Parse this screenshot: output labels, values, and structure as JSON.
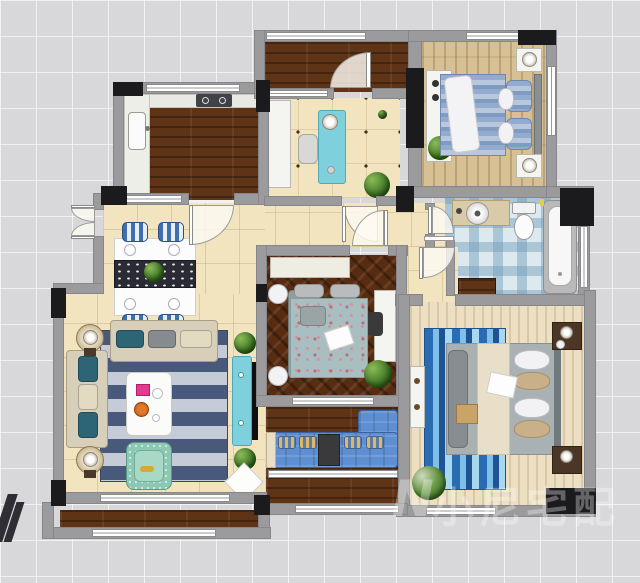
{
  "plan_title": "apartment-floor-plan-top-view",
  "watermark": {
    "logo": "N",
    "text": "小尼宅配",
    "color": "#ffffff",
    "opacity": 0.32
  },
  "rooms": [
    {
      "id": "kitchen",
      "name": "Kitchen",
      "furniture": [
        "l-counter",
        "sink",
        "cooktop",
        "dark-wood-floor"
      ]
    },
    {
      "id": "north-balcony",
      "name": "North Balcony",
      "furniture": [
        "wood-floor",
        "door"
      ]
    },
    {
      "id": "study",
      "name": "Study / Tea Room",
      "furniture": [
        "cabinet",
        "tea-table",
        "stool",
        "plant"
      ]
    },
    {
      "id": "bedroom-2",
      "name": "Bedroom 2",
      "furniture": [
        "double-bed-blue",
        "desk",
        "nightstand-x2",
        "plant"
      ]
    },
    {
      "id": "bathroom",
      "name": "Bathroom",
      "furniture": [
        "vanity-sink",
        "toilet",
        "bathtub",
        "cabinet"
      ]
    },
    {
      "id": "hallway",
      "name": "Hallway",
      "furniture": []
    },
    {
      "id": "bedroom-3",
      "name": "Bedroom 3",
      "furniture": [
        "wardrobe",
        "double-bed-floral",
        "desk",
        "chair",
        "plant",
        "pouf-x2"
      ]
    },
    {
      "id": "master-bedroom",
      "name": "Master Bedroom",
      "furniture": [
        "double-bed-gray",
        "striped-rug",
        "nightstand-x2",
        "tv-cabinet",
        "plant"
      ]
    },
    {
      "id": "living-dining",
      "name": "Living / Dining Room",
      "furniture": [
        "dining-table",
        "dining-chair-x4",
        "sofa-x2",
        "coffee-table",
        "armchair",
        "lamp-table-x2",
        "tv-console",
        "tv",
        "rug",
        "plant-x2",
        "diamond-mat"
      ]
    },
    {
      "id": "south-balcony",
      "name": "South Balcony",
      "furniture": [
        "sectional-sofa-blue",
        "side-table"
      ]
    },
    {
      "id": "outer-balcony",
      "name": "Outer Balcony Strip",
      "furniture": [
        "wood-floor"
      ]
    }
  ],
  "colors": {
    "bgTile": "#d8d8da",
    "wall": "#9b9b9d",
    "wallDark": "#1b1b1e",
    "floorBeige": "#f2e4bf",
    "woodDark": "#5f3315",
    "woodLight": "#d6c094",
    "woodCream": "#ecdfc2",
    "herringbone": "#582c11",
    "bathTile": "#dce9ef",
    "rugNavy": "#49597c",
    "rugLight": "#c5cbd7",
    "accentTeal": "#7ed0dc",
    "sofaBeige": "#d8cfba",
    "sofaBlue": "#5e8fd2",
    "mint": "#8cc8b4",
    "bedBlue": "#8aa6cb"
  }
}
